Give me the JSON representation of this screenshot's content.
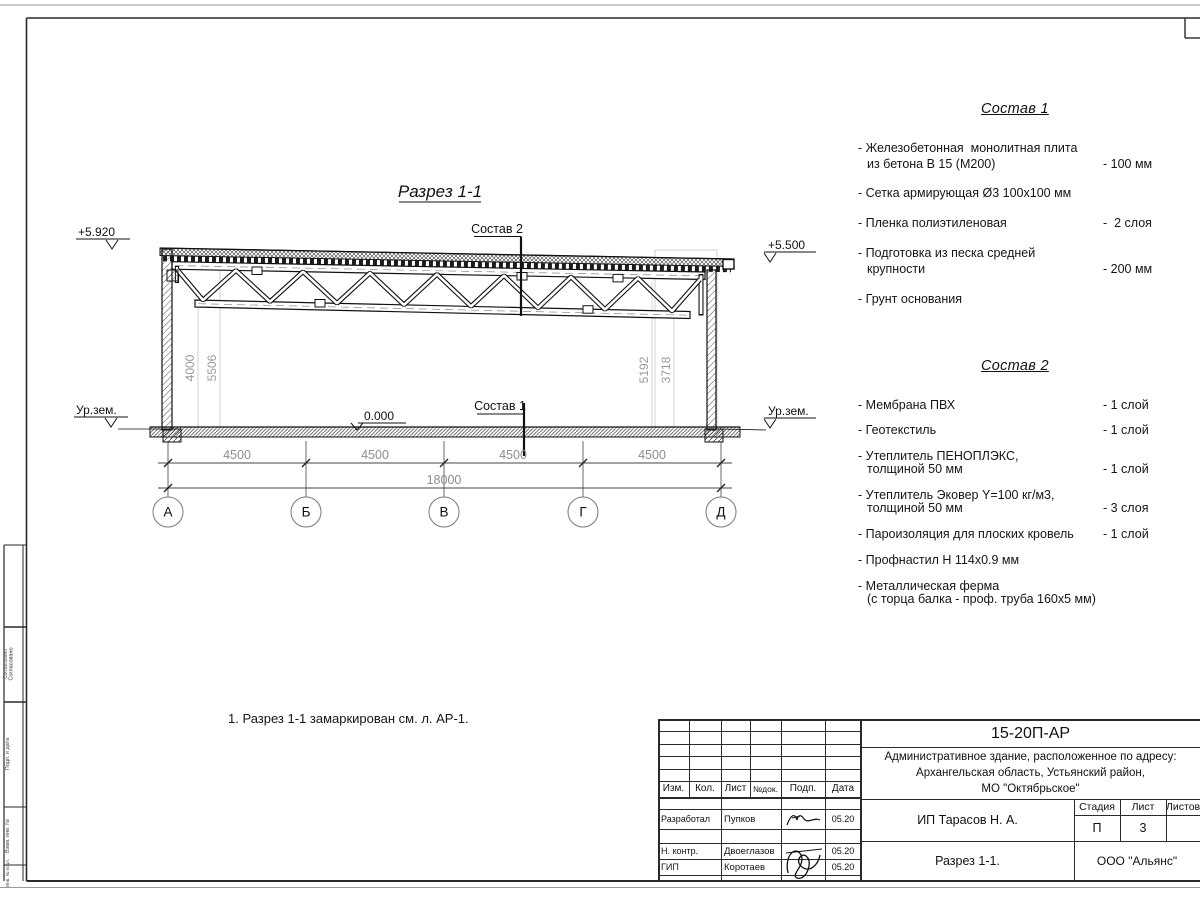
{
  "page": {
    "note": "1. Разрез 1-1 замаркирован см. л. АР-1."
  },
  "drawing": {
    "title": "Разрез 1-1",
    "labels": {
      "comp2": "Состав 2",
      "comp1": "Состав 1",
      "zero": "0.000",
      "elev_left": "+5.920",
      "elev_right": "+5.500",
      "ground_left": "Ур.зем.",
      "ground_right": "Ур.зем."
    },
    "vdims": {
      "left_inner": "4000",
      "left_outer": "5506",
      "right_outer": "5192",
      "right_inner": "3718"
    },
    "hdims": [
      "4500",
      "4500",
      "4500",
      "4500"
    ],
    "total": "18000",
    "axes": [
      "А",
      "Б",
      "В",
      "Г",
      "Д"
    ]
  },
  "comp1": {
    "title": "Состав 1",
    "items": [
      {
        "l1": "- Железобетонная  монолитная плита",
        "l2": "из бетона В 15 (М200)",
        "v": "- 100 мм"
      },
      {
        "l1": "- Сетка армирующая Ø3 100х100 мм",
        "l2": "",
        "v": ""
      },
      {
        "l1": "- Пленка полиэтиленовая",
        "l2": "",
        "v": "-  2 слоя"
      },
      {
        "l1": "- Подготовка из песка средней",
        "l2": "крупности",
        "v": "- 200 мм"
      },
      {
        "l1": "- Грунт основания",
        "l2": "",
        "v": ""
      }
    ]
  },
  "comp2": {
    "title": "Состав 2",
    "items": [
      {
        "l1": "- Мембрана ПВХ",
        "l2": "",
        "v": "- 1 слой"
      },
      {
        "l1": "- Геотекстиль",
        "l2": "",
        "v": "- 1 слой"
      },
      {
        "l1": "- Утеплитель ПЕНОПЛЭКС,",
        "l2": "толщиной 50 мм",
        "v": "- 1 слой"
      },
      {
        "l1": "- Утеплитель Эковер Y=100 кг/м3,",
        "l2": "толщиной 50 мм",
        "v": "- 3 слоя"
      },
      {
        "l1": "- Пароизоляция для плоских кровель",
        "l2": "",
        "v": "- 1 слой"
      },
      {
        "l1": "- Профнастил Н 114х0.9 мм",
        "l2": "",
        "v": ""
      },
      {
        "l1": "- Металлическая ферма",
        "l2": "(с торца балка - проф. труба 160х5 мм)",
        "v": ""
      }
    ]
  },
  "left_strip": {
    "labels": [
      "Согласовано",
      "Подп. и дата",
      "Взам. инв. №",
      "Инв. № подл."
    ]
  },
  "title_block": {
    "doc_number": "15-20П-АР",
    "project_lines": [
      "Административное здание, расположенное по адресу:",
      "Архангельская область, Устьянский район,",
      "МО \"Октябрьское\""
    ],
    "cols": {
      "izm": "Изм.",
      "kol": "Кол.",
      "list": "Лист",
      "ndok": "№док.",
      "podp": "Подп.",
      "data": "Дата"
    },
    "rows": [
      {
        "role": "Разработал",
        "name": "Пупков",
        "date": "05.20"
      },
      {
        "role": "Н. контр.",
        "name": "Двоеглазов",
        "date": "05.20"
      },
      {
        "role": "ГИП",
        "name": "Коротаев",
        "date": "05.20"
      }
    ],
    "client": "ИП Тарасов Н. А.",
    "stage_label": "Стадия",
    "sheet_label": "Лист",
    "sheets_label": "Листов",
    "stage": "П",
    "sheet": "3",
    "sheet_title": "Разрез 1-1.",
    "company": "ООО \"Альянс\""
  }
}
